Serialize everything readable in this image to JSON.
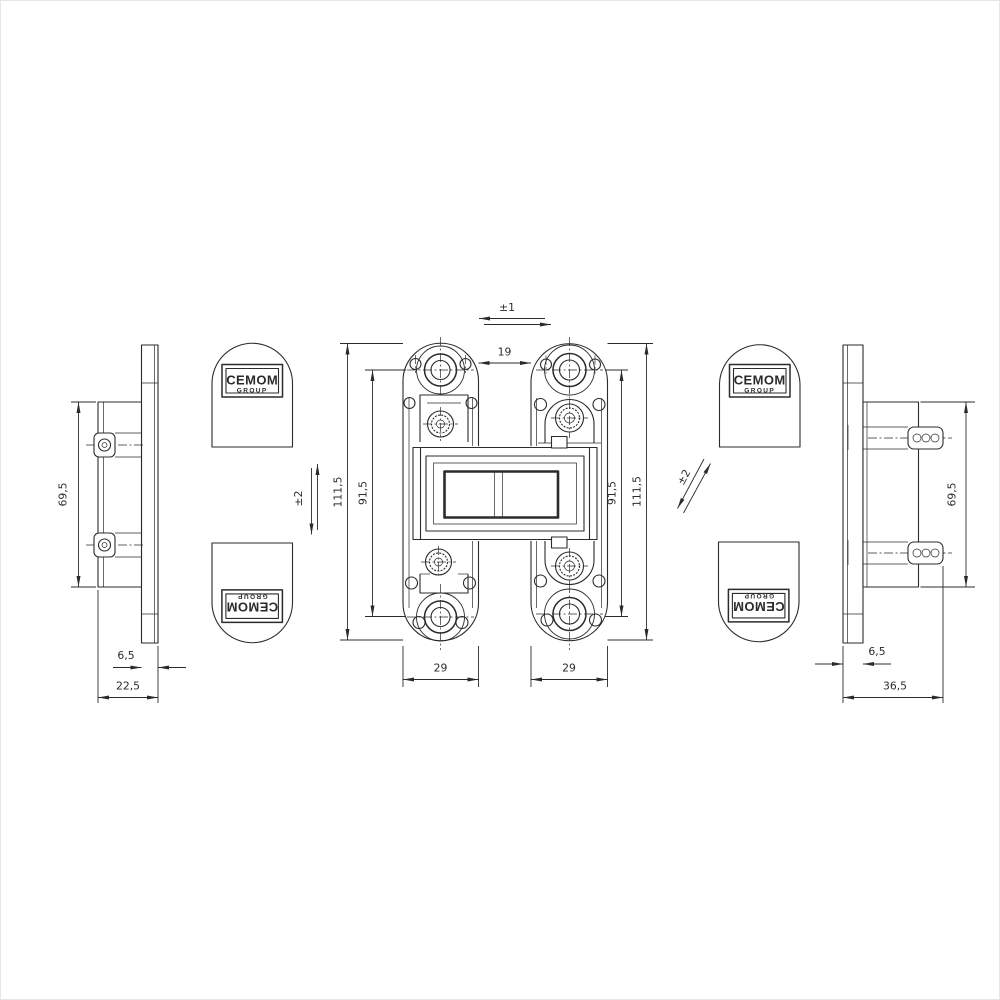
{
  "title": "Concealed hinge technical drawing",
  "brand": {
    "name": "CEMOM",
    "sub": "GROUP"
  },
  "colors": {
    "line": "#2b2b2b",
    "background": "#ffffff"
  },
  "views": {
    "left_profile": {
      "dims": {
        "body_height": "69,5",
        "plate_thickness": "6,5",
        "overall_depth": "22,5"
      }
    },
    "front": {
      "dims": {
        "lateral_adjustment": "±1",
        "door_gap": "19",
        "overall_height_left": "111,5",
        "hole_centers_left": "91,5",
        "hole_centers_right": "91,5",
        "overall_height_right": "111,5",
        "plate_width_left": "29",
        "plate_width_right": "29",
        "height_adjustment": "±2",
        "depth_adjustment": "±2"
      }
    },
    "right_profile": {
      "dims": {
        "body_height": "69,5",
        "plate_thickness": "6,5",
        "overall_depth": "36,5"
      }
    }
  }
}
